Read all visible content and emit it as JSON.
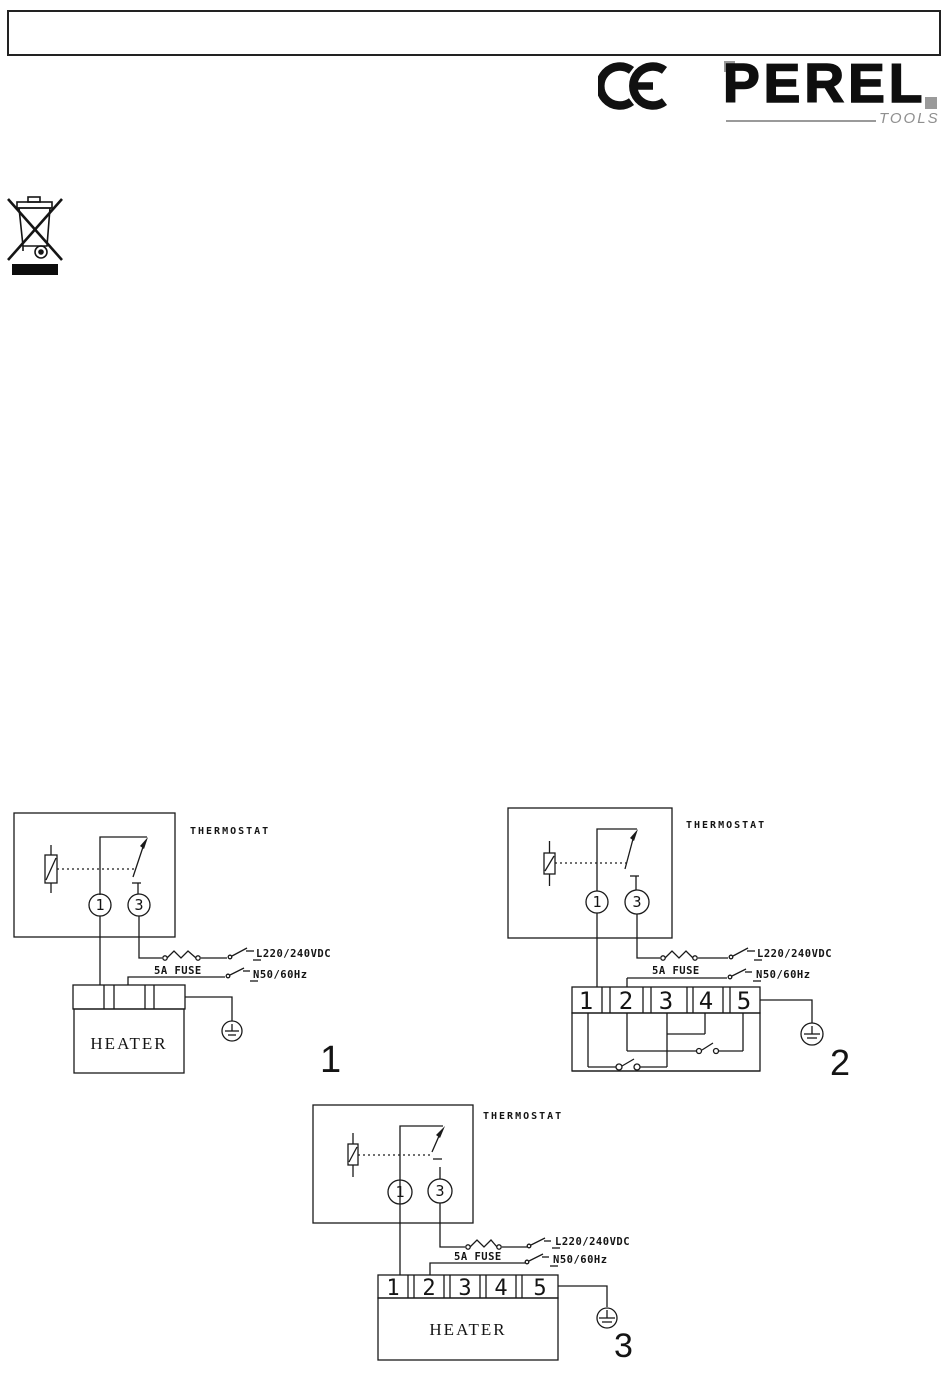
{
  "header": {
    "note_box_text": ""
  },
  "brand": {
    "name": "PEREL",
    "tagline": "TOOLS"
  },
  "icons": {
    "ce": "ce-marking",
    "weee": "weee-crossed-out-wheelie-bin",
    "earth": "protective-earth-ground",
    "fuse": "fuse-symbol",
    "switch": "switch-contact-symbol",
    "sensor": "thermostat-sensor-symbol"
  },
  "colors": {
    "ink": "#1a1a1a",
    "brand_gray": "#8f8f8f"
  },
  "diagrams": {
    "d1": {
      "figure_label": "1",
      "thermostat_label": "THERMOSTAT",
      "contact_left": "1",
      "contact_right": "3",
      "line_label": "L220/240VDC",
      "fuse_label": "5A FUSE",
      "neutral_label": "N50/60Hz",
      "heater_label": "HEATER"
    },
    "d2": {
      "figure_label": "2",
      "thermostat_label": "THERMOSTAT",
      "contact_left": "1",
      "contact_right": "3",
      "line_label": "L220/240VDC",
      "fuse_label": "5A FUSE",
      "neutral_label": "N50/60Hz",
      "terminals": [
        "1",
        "2",
        "3",
        "4",
        "5"
      ]
    },
    "d3": {
      "figure_label": "3",
      "thermostat_label": "THERMOSTAT",
      "contact_left": "1",
      "contact_right": "3",
      "line_label": "L220/240VDC",
      "fuse_label": "5A FUSE",
      "neutral_label": "N50/60Hz",
      "heater_label": "HEATER",
      "terminals": [
        "1",
        "2",
        "3",
        "4",
        "5"
      ]
    }
  }
}
